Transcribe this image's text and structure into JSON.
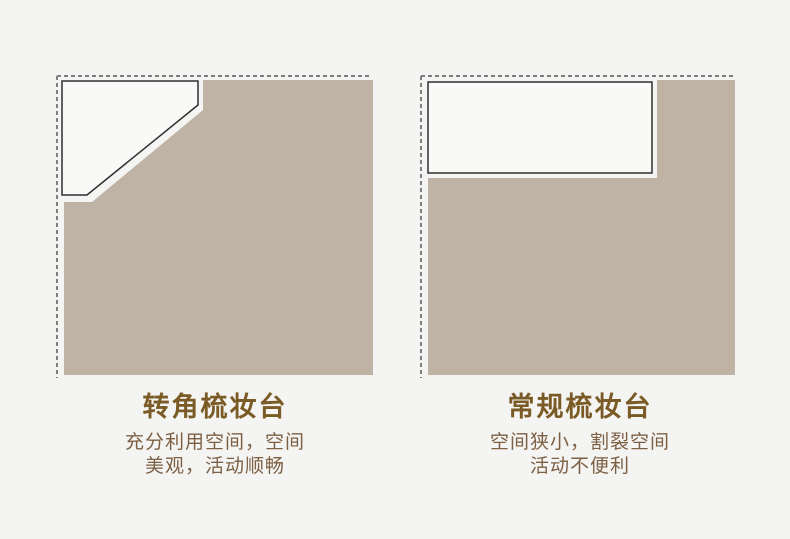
{
  "page": {
    "background": "#f4f4f2"
  },
  "colors": {
    "page_background": "#f4f4f2",
    "floor": "#bfb3a6",
    "furniture_fill": "#f9f9f8",
    "furniture_border": "#2f2f2f",
    "dashed_wall": "#7f7f7f",
    "title": "#7a5a25",
    "description": "#7d6044"
  },
  "comparison": {
    "left": {
      "furniture": "corner-dressing-table",
      "title": "转角梳妆台",
      "description_lines": [
        "充分利用空间，空间",
        "美观，活动顺畅"
      ]
    },
    "right": {
      "furniture": "regular-dressing-table",
      "title": "常规梳妆台",
      "description_lines": [
        "空间狭小，割裂空间",
        "活动不便利"
      ]
    }
  }
}
